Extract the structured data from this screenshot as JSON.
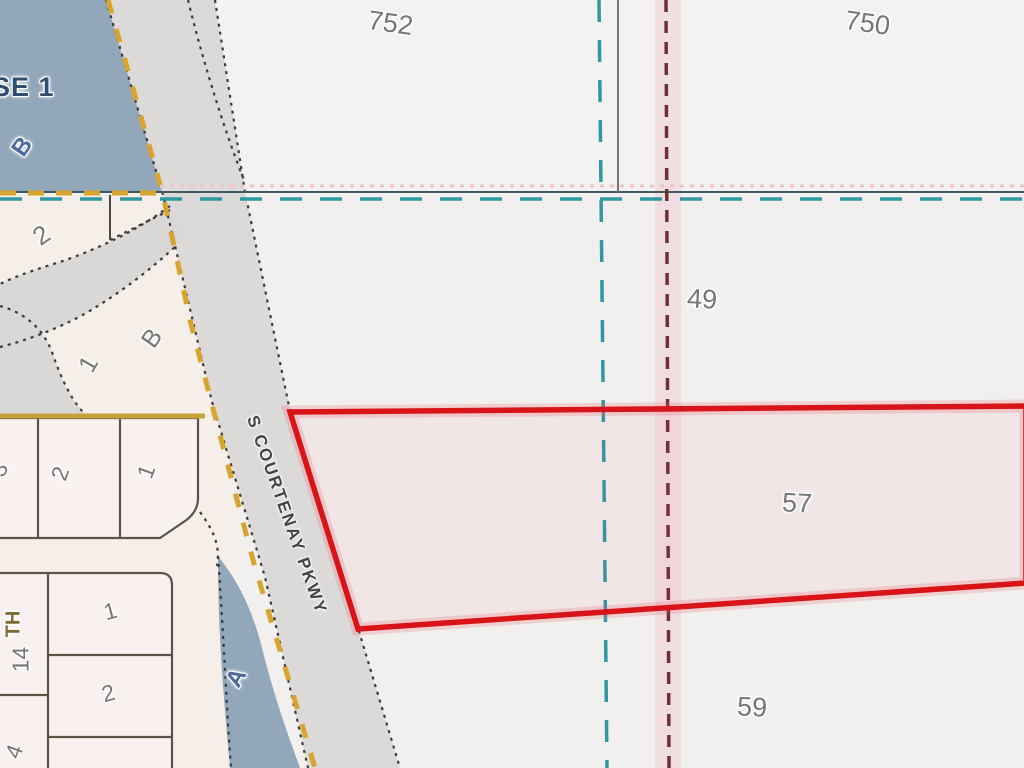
{
  "map": {
    "kind": "cadastral-parcel-map",
    "road_label": "S COURTENAY PKWY",
    "highlighted_parcel": "outlined in red between parcels 49 and 59"
  },
  "labels": {
    "phase": "SE 1",
    "water_b": "B",
    "p752": "752",
    "p750": "750",
    "p49": "49",
    "p57": "57",
    "p59": "59",
    "lot2_curve": "2",
    "lot1_curve": "1",
    "lotB_curve": "B",
    "row_lot3": "3",
    "row_lot2": "2",
    "row_lot1": "1",
    "street_th": "TH",
    "lot14": "14",
    "block2_lot1": "1",
    "block2_lot2": "2",
    "lot4": "4",
    "water_a": "A",
    "road": "S COURTENAY PKWY"
  },
  "colors": {
    "red": "#d81418",
    "red-glow": "rgba(235,90,110,0.22)",
    "teal": "#2f98a2",
    "teal-solid": "#3f5a60",
    "maroon": "#6e3034",
    "pink-band": "rgba(242,190,200,0.35)",
    "pink-hatch": "#f0c2cc",
    "yellow-dash": "#d7a52f",
    "yellow-solid": "#c7a23a",
    "water": "#92a7ba",
    "road-gray": "#dbdad8",
    "line-dark": "#3b3b39",
    "lot-line": "#5a5347",
    "label-gray": "#767674",
    "label-blue": "#4a6b9e",
    "label-navy": "#2f4f6e",
    "label-olive": "#7c6b33"
  }
}
